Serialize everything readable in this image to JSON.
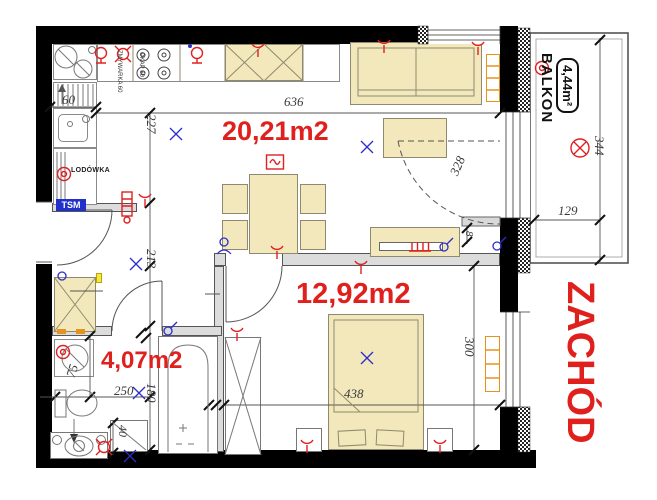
{
  "plan": {
    "rooms": {
      "living": {
        "area": "20,21m2"
      },
      "bedroom": {
        "area": "12,92m2"
      },
      "bathroom": {
        "area": "4,07m2"
      },
      "balcony": {
        "name": "BALKON",
        "area": "4,44m²"
      }
    },
    "orientation": {
      "west": "ZACHÓD"
    },
    "appliances": {
      "fridge": "LODÓWKA",
      "meter_box": "TSM",
      "dishwasher": "ZMYWARKA 60",
      "hood": "OKAP 60"
    },
    "dimensions": {
      "living_width": "636",
      "kitchen_depth": "227",
      "hall_depth": "213",
      "bathtub_length": "180",
      "bedroom_depth": "300",
      "bedroom_width": "438",
      "bathroom_width": "250",
      "washer_zone": "75",
      "shower_width": "40",
      "sink_width": "60",
      "wall_offset": "8",
      "balcony_length": "344",
      "balcony_width": "129",
      "balcony_door_swing": "328"
    },
    "colors": {
      "wall": "#000000",
      "furniture": "#f2e8bb",
      "accent_red": "#e0201d",
      "accent_blue": "#2d2dcc",
      "radiator": "#e8921e"
    }
  }
}
